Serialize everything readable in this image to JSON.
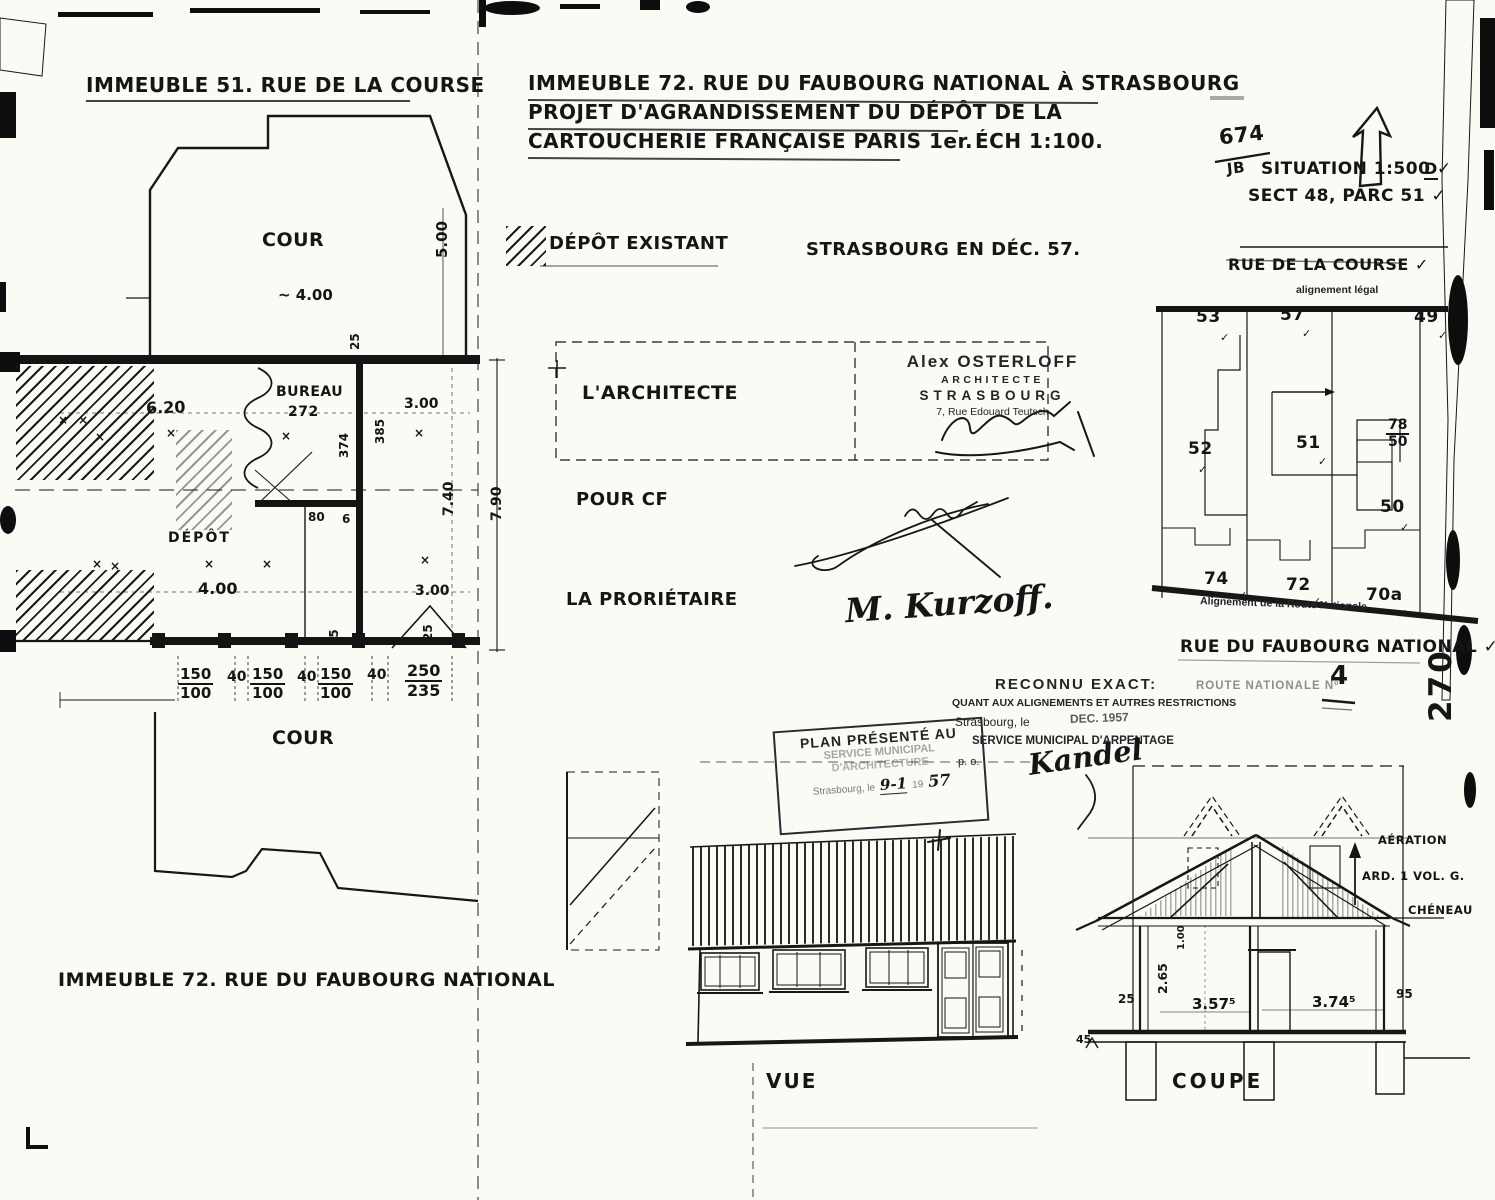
{
  "left_plan": {
    "title": "IMMEUBLE 51. RUE DE LA COURSE",
    "cour_top": "COUR",
    "dim_approx": "~ 4.00",
    "d500": "5.00",
    "d25": "25",
    "bureau": "BUREAU",
    "bureau_no": "272",
    "d620": "6.20",
    "d300": "3.00",
    "d374": "374",
    "d385": "385",
    "d740": "7.40",
    "d790": "7.90",
    "depot": "DÉPÔT",
    "d80": "80",
    "d6": "6",
    "d400": "4.00",
    "d300b": "3.00",
    "f150": {
      "t": "150",
      "b": "100"
    },
    "d40": "40",
    "f250": {
      "t": "250",
      "b": "235"
    },
    "cour_bottom": "COUR",
    "bottom_label": "IMMEUBLE 72. RUE DU FAUBOURG NATIONAL"
  },
  "title_block": {
    "l1": "IMMEUBLE 72. RUE DU FAUBOURG NATIONAL À STRASBOURG",
    "l2": "PROJET D'AGRANDISSEMENT DU DÉPÔT DE LA",
    "l3": "CARTOUCHERIE FRANÇAISE PARIS 1er.",
    "ech": "ÉCH 1:100."
  },
  "legend": {
    "depot_existant": "DÉPÔT EXISTANT",
    "place_date": "STRASBOURG EN DÉC. 57."
  },
  "sign": {
    "architecte": "L'ARCHITECTE",
    "stamp": {
      "name": "Alex OSTERLOFF",
      "role": "ARCHITECTE",
      "city": "STRASBOURG",
      "addr": "7, Rue Edouard Teutsch"
    },
    "pour_cf": "POUR CF",
    "proprietaire": "LA PRORIÉTAIRE",
    "proprietaire_sig": "M. Kurzoff."
  },
  "situation": {
    "num": "674",
    "den": "JB",
    "situation": "SITUATION 1:500 ✓",
    "sect": "SECT 48, PARC 51 ✓",
    "d": "D"
  },
  "siteplan": {
    "street_top": "RUE DE LA COURSE ✓",
    "align_legal": "alignement légal",
    "p53": "53",
    "p57": "57",
    "p49": "49",
    "p52": "52",
    "p51": "51",
    "f78": {
      "t": "78",
      "b": "50"
    },
    "p50": "50",
    "p74": "74",
    "p72": "72",
    "p70a": "70a",
    "align_rn": "Alignement de la Route Nationale",
    "street_bottom": "RUE DU FAUBOURG NATIONAL ✓",
    "route": "ROUTE NATIONALE Nº",
    "rnum": "4",
    "page": "270"
  },
  "stamps": {
    "rec1": "RECONNU EXACT:",
    "rec2": "QUANT AUX ALIGNEMENTS ET AUTRES RESTRICTIONS",
    "rec3": "Strasbourg, le",
    "rec_date": "DEC. 1957",
    "rec4": "SERVICE MUNICIPAL D'ARPENTAGE",
    "rec5": "p. o.",
    "rec_sig": "Kandel",
    "pres1": "PLAN PRÉSENTÉ AU",
    "pres2": "SERVICE MUNICIPAL",
    "pres3": "D'ARCHITECTURE",
    "pres4": "Strasbourg, le",
    "pres_d1": "9-1",
    "pres_d2": "19",
    "pres_d3": "57"
  },
  "vue": {
    "label": "VUE"
  },
  "coupe": {
    "label": "COUPE",
    "aeration": "AÉRATION",
    "ard": "ARD. 1 VOL. G.",
    "cheneau": "CHÉNEAU",
    "d100": "1.00",
    "d265": "2.65",
    "d25": "25",
    "d357": "3.57⁵",
    "d374": "3.74⁵",
    "d95": "95",
    "d45": "45"
  },
  "marks": {
    "check": "✓",
    "x": "×"
  }
}
